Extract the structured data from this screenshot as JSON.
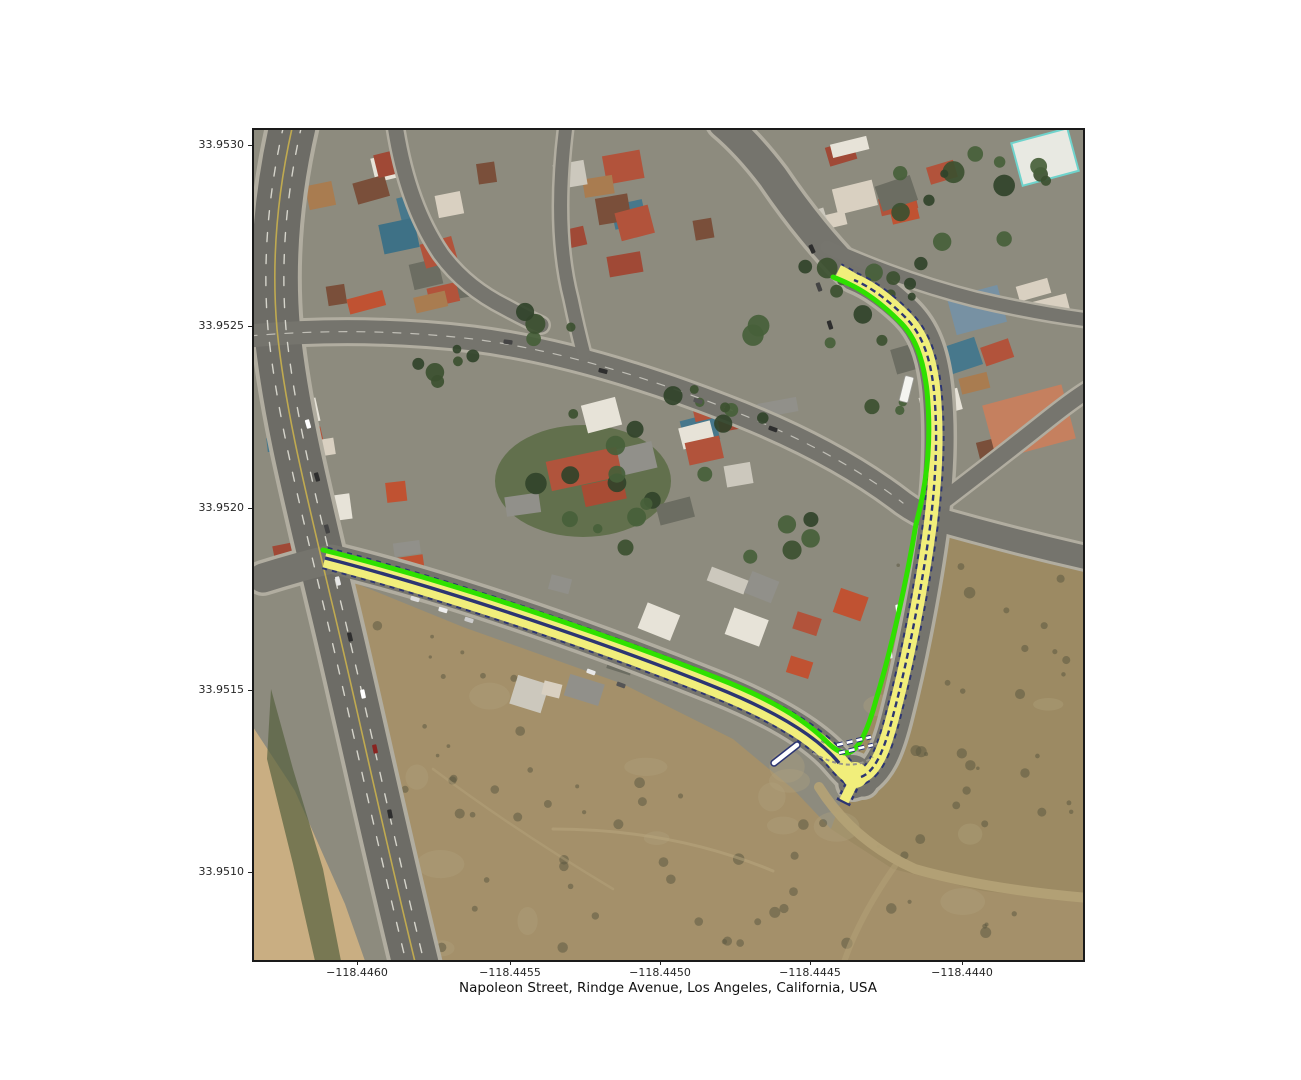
{
  "figure": {
    "caption": "Napoleon Street, Rindge Avenue, Los Angeles, California, USA"
  },
  "axes": {
    "y_ticks": [
      "33.9530",
      "33.9525",
      "33.9520",
      "33.9515",
      "33.9510"
    ],
    "x_ticks": [
      "−118.4460",
      "−118.4455",
      "−118.4450",
      "−118.4445",
      "−118.4440"
    ]
  },
  "map": {
    "route_colors": {
      "road_fill": "#f1ee7b",
      "edge_line": "#2fe000",
      "lane_line": "#2c3572",
      "marking": "#ffffff"
    },
    "ground_colors": {
      "urban": "#8d8b7e",
      "field": "#a4906a",
      "road": "#75746d"
    }
  }
}
